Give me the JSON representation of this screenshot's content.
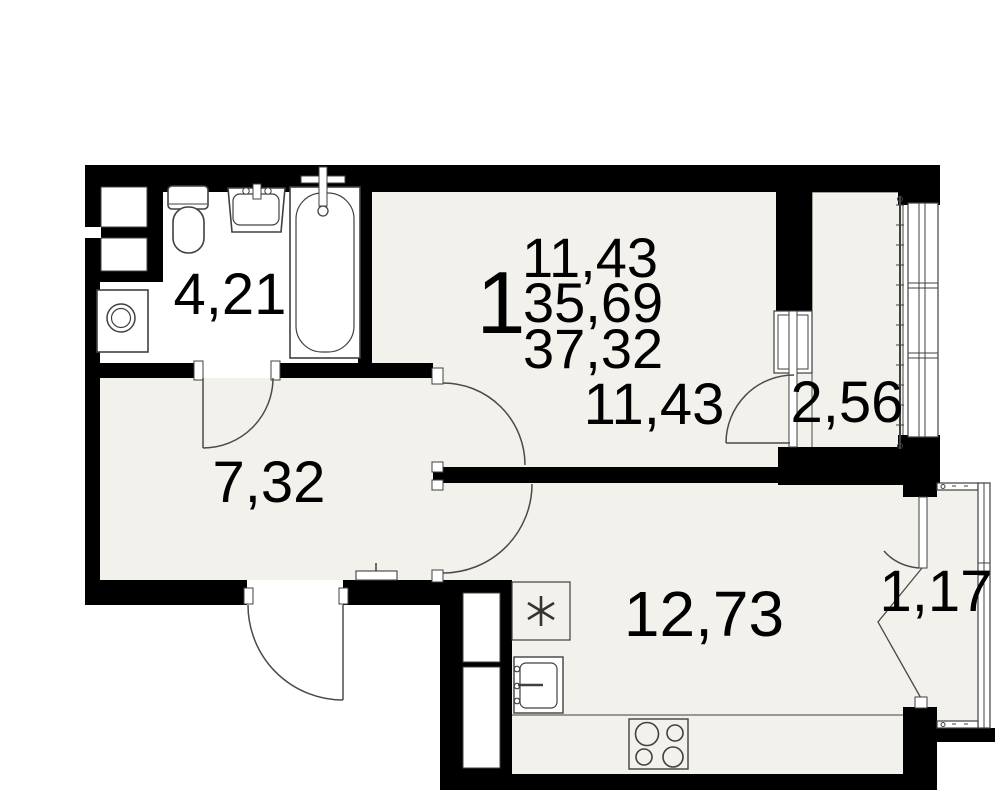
{
  "plan_type": "apartment-floor-plan",
  "summary": {
    "rooms_count": "1",
    "living_area": "11,43",
    "area_without_balcony": "35,69",
    "total_area": "37,32"
  },
  "rooms": {
    "bathroom": "4,21",
    "hallway": "7,32",
    "living_room": "11,43",
    "kitchen": "12,73",
    "loggia": "2,56",
    "balcony": "1,17"
  },
  "fixtures": [
    "toilet",
    "bathroom-sink",
    "bathtub",
    "washing-machine",
    "ventilation-shaft",
    "kitchen-sink",
    "stove"
  ],
  "colors": {
    "walls": "#000000",
    "floor": "#f2f1ec",
    "bathroom_floor": "#ffffff",
    "lines": "#404040",
    "background": "#ffffff",
    "text": "#000000"
  }
}
